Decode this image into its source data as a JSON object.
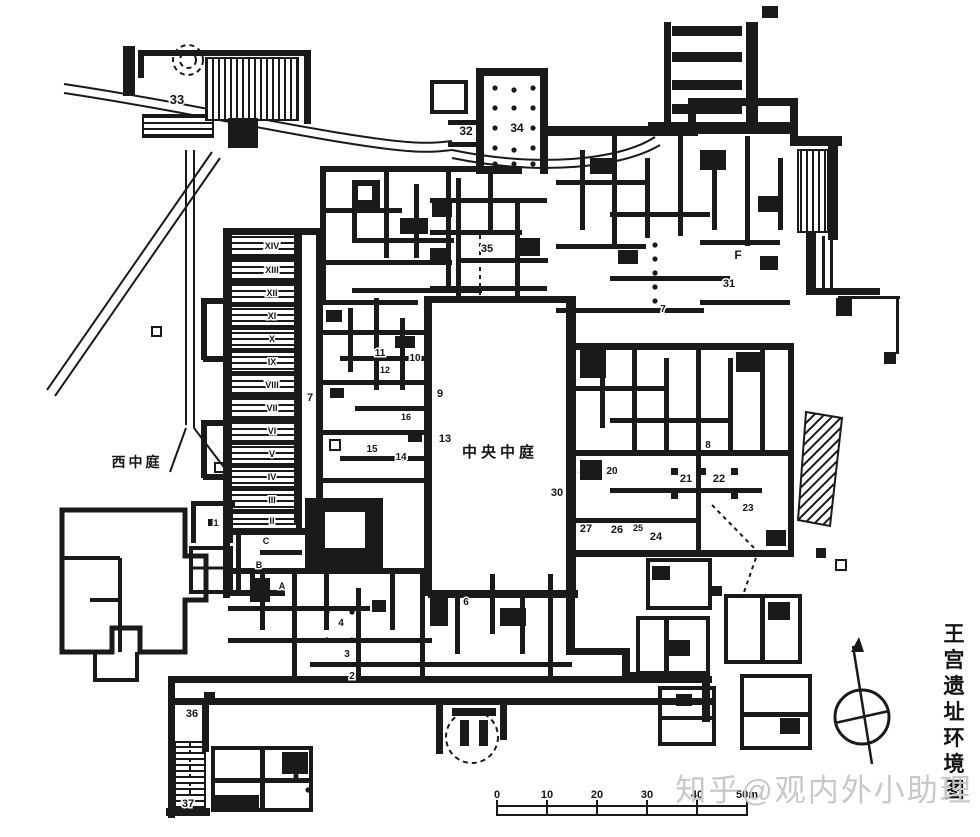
{
  "figure": {
    "background": "#ffffff",
    "ink": "#1a1a1a",
    "caption_vertical": "王宫遗址环境图",
    "watermark": {
      "text": "知乎@观内外小助理",
      "color": "#c8c8c8"
    }
  },
  "courts": {
    "west_court": "西中庭",
    "central_court": "中央中庭"
  },
  "scale_bar": {
    "labels": [
      "0",
      "10",
      "20",
      "30",
      "40",
      "50m"
    ],
    "unit": "m"
  },
  "compass": {
    "type": "north-arrow-circle"
  },
  "plan_labels": [
    {
      "t": "33",
      "x": 177,
      "y": 104,
      "s": 13,
      "halo": true
    },
    {
      "t": "32",
      "x": 466,
      "y": 135,
      "s": 12,
      "halo": true
    },
    {
      "t": "34",
      "x": 517,
      "y": 132,
      "s": 12,
      "halo": true
    },
    {
      "t": "35",
      "x": 487,
      "y": 252,
      "s": 11,
      "halo": true
    },
    {
      "t": "F",
      "x": 738,
      "y": 259,
      "s": 12,
      "halo": true
    },
    {
      "t": "31",
      "x": 729,
      "y": 287,
      "s": 11,
      "halo": true
    },
    {
      "t": "7",
      "x": 663,
      "y": 312,
      "s": 10,
      "halo": true
    },
    {
      "t": "7",
      "x": 310,
      "y": 401,
      "s": 11,
      "halo": false
    },
    {
      "t": "11",
      "x": 380,
      "y": 356,
      "s": 10,
      "halo": true
    },
    {
      "t": "10",
      "x": 415,
      "y": 361,
      "s": 10,
      "halo": true
    },
    {
      "t": "12",
      "x": 385,
      "y": 373,
      "s": 9,
      "halo": true
    },
    {
      "t": "9",
      "x": 440,
      "y": 397,
      "s": 11,
      "halo": true
    },
    {
      "t": "16",
      "x": 406,
      "y": 420,
      "s": 9,
      "halo": true
    },
    {
      "t": "13",
      "x": 445,
      "y": 442,
      "s": 11,
      "halo": true
    },
    {
      "t": "15",
      "x": 372,
      "y": 452,
      "s": 10,
      "halo": true
    },
    {
      "t": "14",
      "x": 401,
      "y": 460,
      "s": 10,
      "halo": true
    },
    {
      "t": "5",
      "x": 344,
      "y": 561,
      "s": 10,
      "white": true
    },
    {
      "t": "30",
      "x": 557,
      "y": 496,
      "s": 11,
      "halo": true
    },
    {
      "t": "20",
      "x": 612,
      "y": 474,
      "s": 10,
      "halo": true
    },
    {
      "t": "21",
      "x": 686,
      "y": 482,
      "s": 11,
      "halo": true
    },
    {
      "t": "22",
      "x": 719,
      "y": 482,
      "s": 11,
      "halo": true
    },
    {
      "t": "23",
      "x": 748,
      "y": 511,
      "s": 10,
      "halo": true
    },
    {
      "t": "27",
      "x": 586,
      "y": 532,
      "s": 11,
      "halo": true
    },
    {
      "t": "26",
      "x": 617,
      "y": 533,
      "s": 11,
      "halo": true
    },
    {
      "t": "25",
      "x": 638,
      "y": 531,
      "s": 9,
      "halo": true
    },
    {
      "t": "24",
      "x": 656,
      "y": 540,
      "s": 11,
      "halo": true
    },
    {
      "t": "8",
      "x": 708,
      "y": 448,
      "s": 10,
      "halo": true
    },
    {
      "t": "6",
      "x": 466,
      "y": 605,
      "s": 10,
      "halo": true
    },
    {
      "t": "4",
      "x": 341,
      "y": 626,
      "s": 10,
      "halo": true
    },
    {
      "t": "3",
      "x": 347,
      "y": 657,
      "s": 10,
      "halo": true
    },
    {
      "t": "2",
      "x": 352,
      "y": 679,
      "s": 10,
      "halo": true
    },
    {
      "t": "1",
      "x": 216,
      "y": 526,
      "s": 9,
      "halo": true
    },
    {
      "t": "A",
      "x": 282,
      "y": 589,
      "s": 9,
      "halo": true
    },
    {
      "t": "B",
      "x": 259,
      "y": 568,
      "s": 9,
      "halo": true
    },
    {
      "t": "C",
      "x": 266,
      "y": 544,
      "s": 9,
      "halo": true
    },
    {
      "t": "36",
      "x": 192,
      "y": 717,
      "s": 11,
      "halo": true
    },
    {
      "t": "37",
      "x": 188,
      "y": 807,
      "s": 11,
      "halo": true
    },
    {
      "t": "II",
      "x": 272,
      "y": 524,
      "s": 9,
      "halo": true
    },
    {
      "t": "III",
      "x": 272,
      "y": 503,
      "s": 9,
      "halo": true
    },
    {
      "t": "IV",
      "x": 272,
      "y": 480,
      "s": 9,
      "halo": true
    },
    {
      "t": "V",
      "x": 272,
      "y": 457,
      "s": 9,
      "halo": true
    },
    {
      "t": "VI",
      "x": 272,
      "y": 434,
      "s": 9,
      "halo": true
    },
    {
      "t": "VII",
      "x": 272,
      "y": 411,
      "s": 9,
      "halo": true
    },
    {
      "t": "VIII",
      "x": 272,
      "y": 388,
      "s": 9,
      "halo": true
    },
    {
      "t": "IX",
      "x": 272,
      "y": 365,
      "s": 9,
      "halo": true
    },
    {
      "t": "X",
      "x": 272,
      "y": 342,
      "s": 9,
      "halo": true
    },
    {
      "t": "XI",
      "x": 272,
      "y": 319,
      "s": 9,
      "halo": true
    },
    {
      "t": "XII",
      "x": 272,
      "y": 296,
      "s": 9,
      "halo": true
    },
    {
      "t": "XIII",
      "x": 272,
      "y": 273,
      "s": 9,
      "halo": true
    },
    {
      "t": "XIV",
      "x": 272,
      "y": 249,
      "s": 9,
      "halo": true
    },
    {
      "t": "中央中庭",
      "x": 500,
      "y": 457,
      "s": 15,
      "ls": 4,
      "halo": true
    },
    {
      "t": "西中庭",
      "x": 137,
      "y": 467,
      "s": 14,
      "ls": 3,
      "halo": false
    }
  ]
}
